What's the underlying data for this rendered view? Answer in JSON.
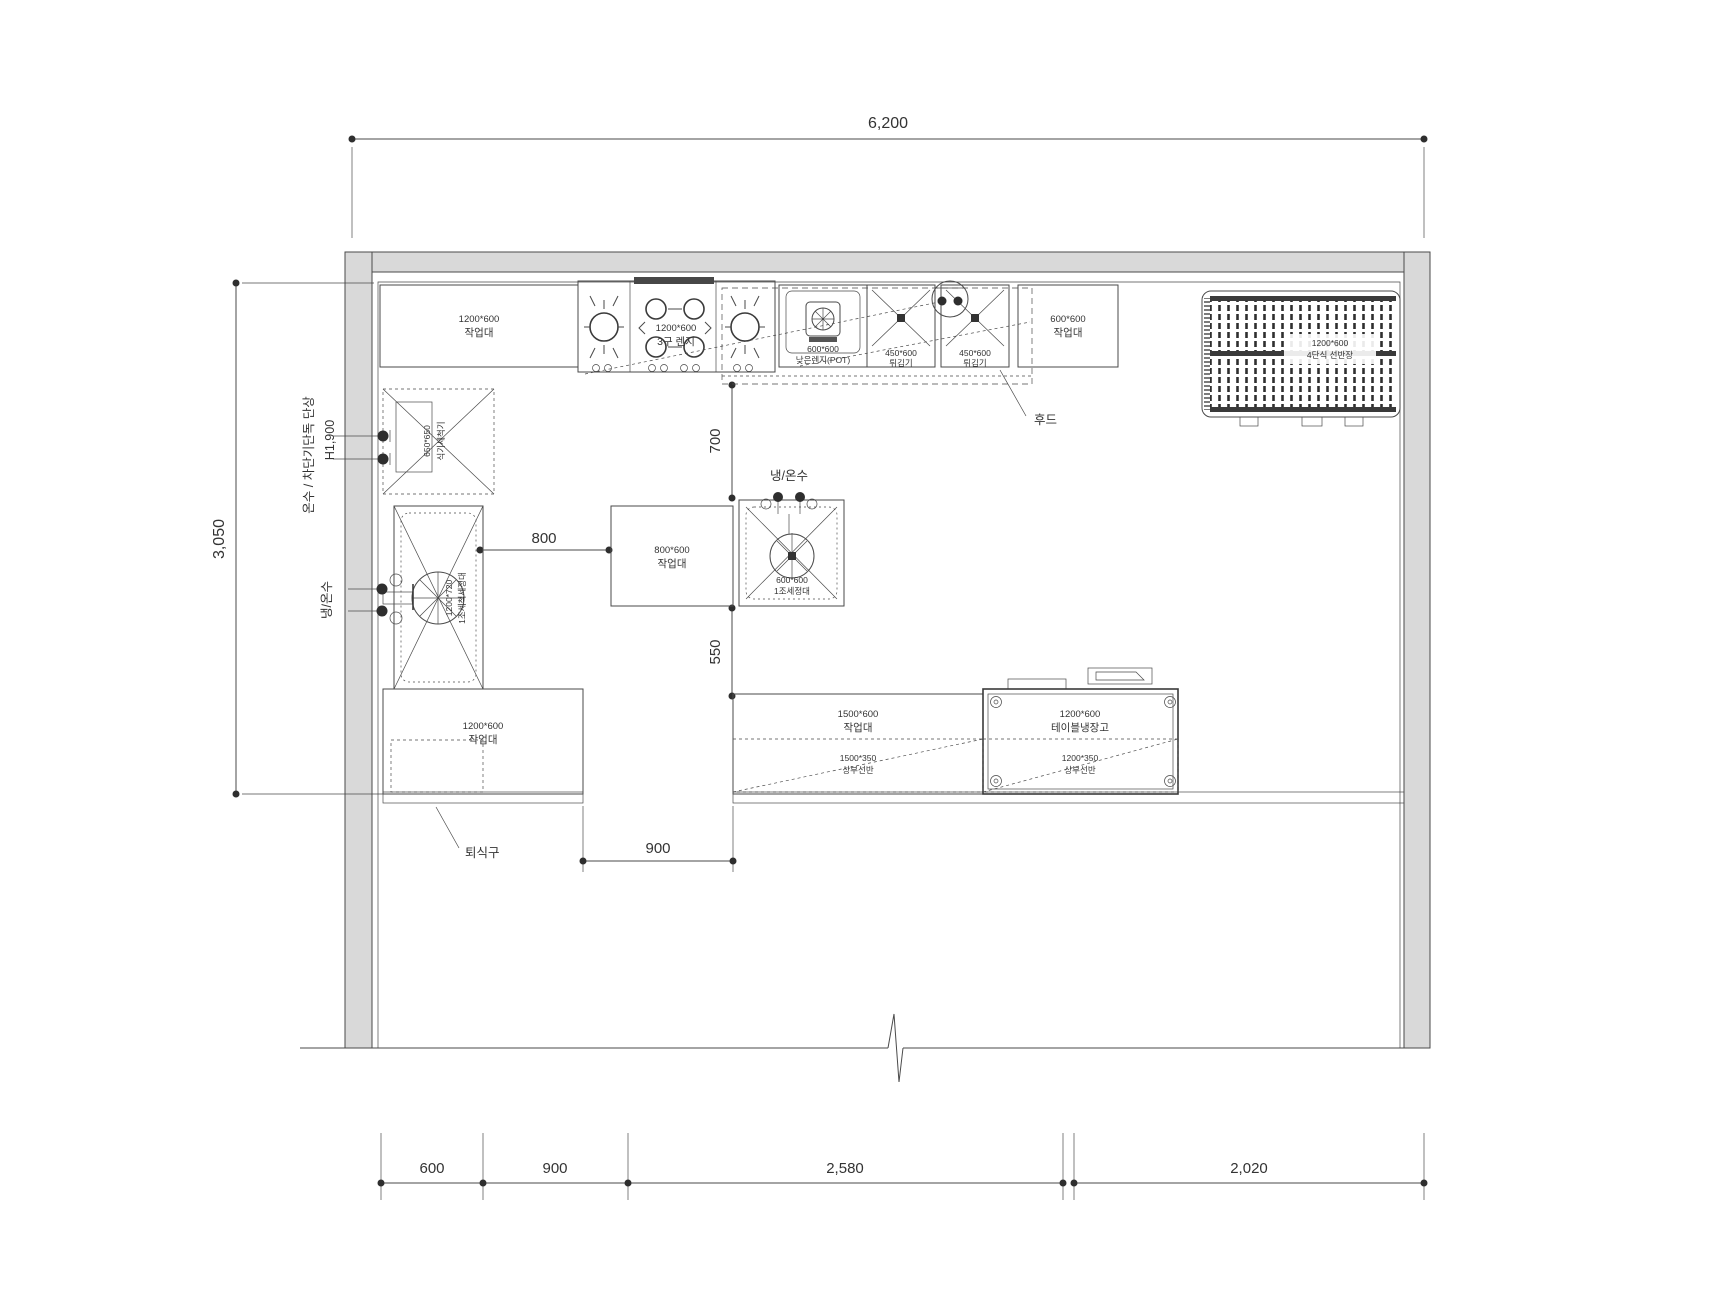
{
  "drawing": {
    "dimensions": {
      "overall_width": "6,200",
      "overall_depth": "3,050",
      "aisle_700": "700",
      "aisle_550": "550",
      "gap_800": "800",
      "gap_900": "900",
      "bottom_600": "600",
      "bottom_900": "900",
      "bottom_2580": "2,580",
      "bottom_2020": "2,020"
    },
    "annotations": {
      "power": "온수 / 차단기단독 단상",
      "power_height": "H1,900",
      "water_left": "냉/온수",
      "water_mid": "냉/온수",
      "hood": "후드",
      "return_opening": "퇴식구"
    },
    "equipment": {
      "worktable_top_left": {
        "size": "1200*600",
        "name": "작업대"
      },
      "gas_range": {
        "size": "1200*600",
        "name": "3구 렌지"
      },
      "low_range_pot": {
        "size": "600*600",
        "name": "낮은렌지(POT)"
      },
      "fryer_1": {
        "size": "450*600",
        "name": "튀김기"
      },
      "fryer_2": {
        "size": "450*600",
        "name": "튀김기"
      },
      "worktable_top_right": {
        "size": "600*600",
        "name": "작업대"
      },
      "shelf_rack": {
        "size": "1200*600",
        "name": "4단식 선반장"
      },
      "dishwasher": {
        "size": "650*650",
        "name": "식기세척기"
      },
      "wash_sink": {
        "size": "1200*720",
        "name": "1조세척세정대"
      },
      "worktable_bottom_left": {
        "size": "1200*600",
        "name": "작업대"
      },
      "worktable_center": {
        "size": "800*600",
        "name": "작업대"
      },
      "sink_center": {
        "size": "600*600",
        "name": "1조세정대"
      },
      "worktable_bottom": {
        "size": "1500*600",
        "name": "작업대"
      },
      "upper_shelf_1": {
        "size": "1500*350",
        "name": "상부선반"
      },
      "refrigerator": {
        "size": "1200*600",
        "name": "테이블냉장고"
      },
      "upper_shelf_2": {
        "size": "1200*350",
        "name": "상부선반"
      }
    },
    "colors": {
      "wall_fill": "#d9d9d9",
      "line": "#4a4a4a",
      "text": "#333333"
    }
  }
}
